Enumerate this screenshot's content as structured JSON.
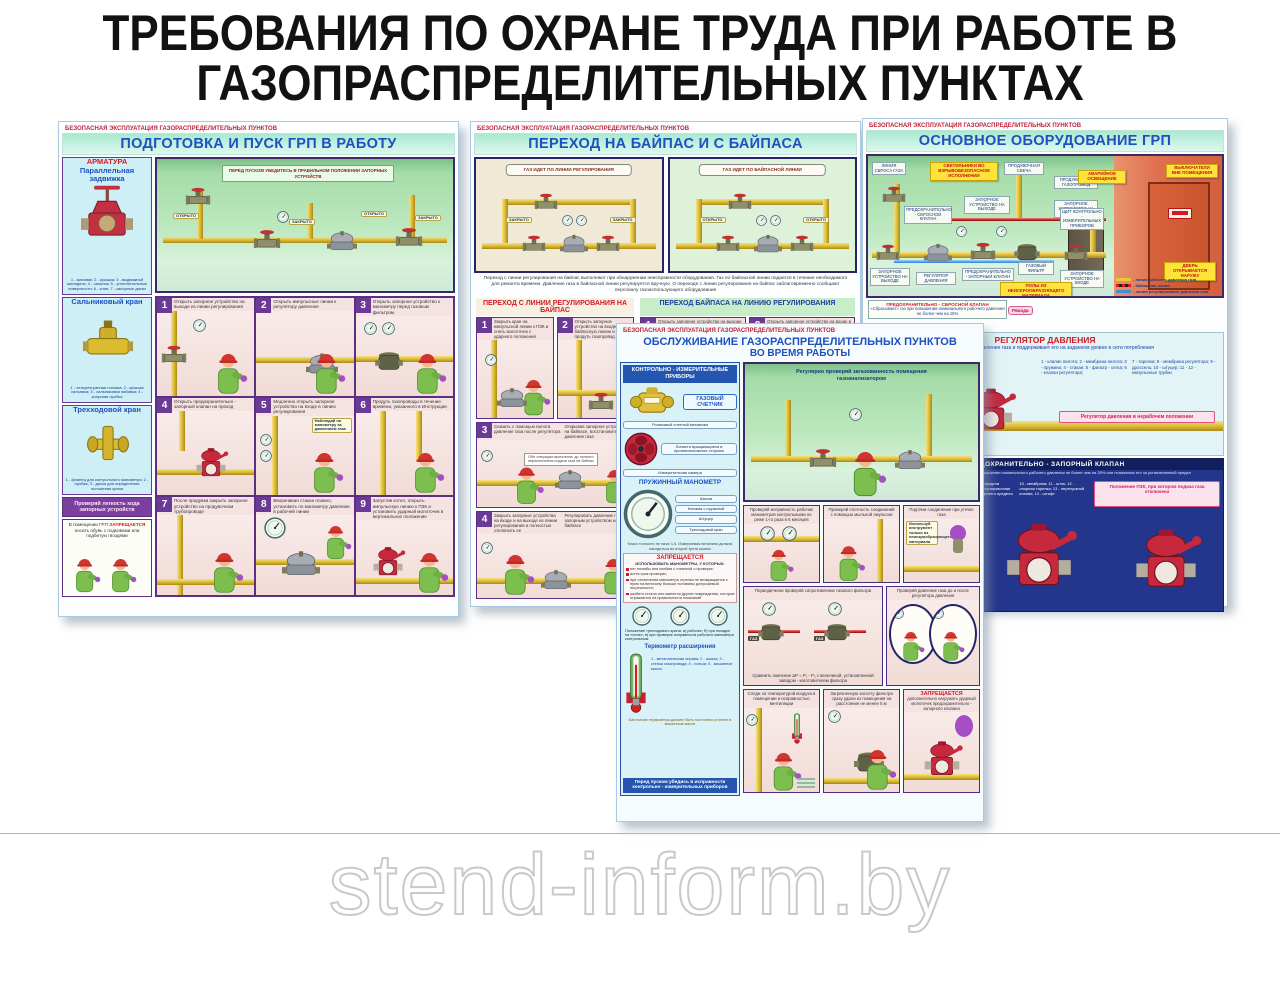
{
  "page": {
    "title_l1": "ТРЕБОВАНИЯ ПО ОХРАНЕ ТРУДА ПРИ РАБОТЕ В",
    "title_l2": "ГАЗОПРАСПРЕДЕЛИТЕЛЬНЫХ ПУНКТАХ",
    "series_label": "БЕЗОПАСНАЯ ЭКСПЛУАТАЦИЯ ГАЗОРАСПРЕДЕЛИТЕЛЬНЫХ ПУНКТОВ",
    "watermark": "stend-inform.by"
  },
  "p1": {
    "title": "ПОДГОТОВКА И ПУСК ГРП В РАБОТУ",
    "arm_title": "АРМАТУРА",
    "arm_sub": "Параллельная задвижка",
    "arm_caption": "1 - маховик; 2 - крышка; 3 - выдвижной шпиндель; 4 - сальник; 5 - уплотнительные поверхности; 6 - клин; 7 - запорные диски",
    "gland_title": "Сальниковый кран",
    "gland_caption": "1 - четырехгранная головка; 2 - крышка сальника; 3 - сальниковая набивка; 4 - конусная пробка",
    "three_title": "Трехходовой кран",
    "three_caption": "1 - фланец для контрольного манометра; 2 - пробка; 3 - диски для определения положения крана",
    "note": "Проверяй легкость хода запорных устройств",
    "warn_a": "В помещении ГРП",
    "warn_b": "ЗАПРЕЩАЕТСЯ",
    "warn_c": "носить обувь с подковами или подбитую гвоздями",
    "banner": "ПЕРЕД ПУСКОМ УБЕДИТЕСЬ В ПРАВИЛЬНОМ ПОЛОЖЕНИИ ЗАПОРНЫХ УСТРОЙСТВ",
    "lbl_open": "ОТКРЫТО",
    "lbl_closed": "ЗАКРЫТО",
    "step5_note": "Наблюдай по манометру за давлением газа",
    "steps": [
      {
        "n": "1",
        "text": "Открыть запорное устройство на выходе из линии регулирования"
      },
      {
        "n": "2",
        "text": "Открыть импульсные линии к регулятору давления"
      },
      {
        "n": "3",
        "text": "Открыть запорное устройство к манометру перед газовым фильтром"
      },
      {
        "n": "4",
        "text": "Открыть предохранительно - запорный клапан на проход"
      },
      {
        "n": "5",
        "text": "Медленно открыть запорное устройство на входе в линию регулирования"
      },
      {
        "n": "6",
        "text": "Продуть газопроводы в течение времени, указанного в Инструкции"
      },
      {
        "n": "7",
        "text": "После продувки закрыть запорное устройство на продувочном трубопроводе"
      },
      {
        "n": "8",
        "text": "Вворачивая стакан плавно, установить по манометру давление в рабочей линии"
      },
      {
        "n": "9",
        "text": "Запустив котел, открыть импульсную линию к ПЗК и установить ударный молоточек в вертикальное положение"
      }
    ]
  },
  "p2": {
    "title": "ПЕРЕХОД НА БАЙПАС И С БАЙПАСА",
    "sch_left": "ГАЗ ИДЕТ ПО ЛИНИИ РЕГУЛИРОВАНИЯ",
    "sch_right": "ГАЗ ИДЕТ ПО БАЙПАСНОЙ ЛИНИИ",
    "lbl_closed": "ЗАКРЫТО",
    "lbl_open": "ОТКРЫТО",
    "paragraph": "Переход с линии регулирования на байпас выполняют при обнаружении неисправности оборудования. Газ по байпасной линии подается в течение необходимого для ремонта времени. Давление газа в байпасной линии регулируется вручную. О переходе с линии регулирования на байпас заблаговременно сообщают персоналу газоиспользующего оборудования",
    "left_title": "ПЕРЕХОД С ЛИНИИ РЕГУЛИРОВАНИЯ НА БАЙПАС",
    "right_title": "ПЕРЕХОД БАЙПАСА НА ЛИНИЮ РЕГУЛИРОВАНИЯ",
    "steps_left": [
      {
        "n": "1",
        "text": "Закрыть кран на импульсной линии к ПЗК и снять молоточек с ударного положения"
      },
      {
        "n": "2",
        "text": "Открыть запорное устройство на входе в байпасную линию и продуть газопровод"
      },
      {
        "n": "3",
        "text": "Снизить с помощью пилота давление газа после регулятора",
        "side": "Открывая запорное устройство на байпасе, восстановить давление газа",
        "extra": "Обе операции выполнять до полного переключения подачи газа на байпас"
      },
      {
        "n": "4",
        "text": "Закрыть запорные устройства на входе и на выходе из линии регулирования и полностью отключить ее",
        "side": "Регулировать давление газа запорным устройством на байпасе"
      }
    ],
    "steps_right": [
      {
        "n": "1",
        "text": "Открыть запорное устройство на выходе из линии регулирования, открыть на проход предохранительно - запорный клапан"
      },
      {
        "n": "2",
        "text": "Открыть запорное устройство на входе в линию регулирования и продуть газопровод"
      }
    ]
  },
  "p3": {
    "title": "ОСНОВНОЕ ОБОРУДОВАНИЕ ГРП",
    "labels": {
      "sbros": "ЛИНИЯ СБРОСА ГАЗА",
      "svet": "СВЕТИЛЬНИКИ ВО ВЗРЫВОБЕЗОПАСНОМ ИСПОЛНЕНИИ",
      "svecha": "ПРОДУВОЧНАЯ СВЕЧА",
      "prod_gas": "ПРОДУВОЧНЫЙ ГАЗОПРОВОД",
      "avar": "АВАРИЙНОЕ ОСВЕЩЕНИЕ",
      "vykl": "ВЫКЛЮЧАТЕЛИ ВНЕ ПОМЕЩЕНИЯ",
      "psk": "ПРЕДОХРАНИТЕЛЬНО - СБРОСНОЙ КЛАПАН",
      "zu_out_top": "ЗАПОРНОЕ УСТРОЙСТВО НА ВЫХОДЕ",
      "zu_in_top": "ЗАПОРНОЕ УСТРОЙСТВО НА ВХОДЕ",
      "shchit": "ЩИТ КОНТРОЛЬНО - ИЗМЕРИТЕЛЬНЫХ ПРИБОРОВ",
      "zu_out_bot": "ЗАПОРНОЕ УСТРОЙСТВО НА ВЫХОДЕ",
      "reg": "РЕГУЛЯТОР ДАВЛЕНИЯ",
      "pzk": "ПРЕДОХРАНИТЕЛЬНО - ЗАПОРНЫЙ КЛАПАН",
      "filter": "ГАЗОВЫЙ ФИЛЬТР",
      "zu_in_bot": "ЗАПОРНОЕ УСТРОЙСТВО НА ВХОДЕ",
      "door": "ДВЕРЬ ОТКРЫВАЕТСЯ НАРУЖУ",
      "pol": "ПОЛЫ ИЗ НЕИСКРООБРАЗУЮЩЕГО МАТЕРИАЛА"
    },
    "legend": [
      "- линия рабочего давления газа",
      "- байпасная линия",
      "- линия регулирования давления газа"
    ],
    "psk_note_title": "ПРЕДОХРАНИТЕЛЬНО - СБРОСНОЙ КЛАПАН",
    "psk_note_text": "«Сбрасывает» газ при повышении номинального рабочего давления не более чем на 15%",
    "p_in": "Рвхода",
    "reg": {
      "title": "РЕГУЛЯТОР ДАВЛЕНИЯ",
      "subtitle": "Снижает входное давление газа и поддерживает его на заданном уровне в сети потребления",
      "parts_a": "1 - клапан пилота; 2 - мембрана пилота; 3 - пружина; 4 - стакан; 5 - фильтр - сетка; 6 - клапан регулятора;",
      "parts_b": "7 - тарелки; 8 - мембрана регулятора; 9 - дроссель; 10 - штуцер; 11 - 12 - импульсные трубки",
      "note": "Регулятор давления в нерабочем положении"
    },
    "pzk": {
      "title": "ПРЕДОХРАНИТЕЛЬНО - ЗАПОРНЫЙ КЛАПАН",
      "subtitle": "Автоматически отключает подачу газа при повышении номинального рабочего давления не более чем на 25% или понижении его за установленный предел",
      "parts_a": "1 - ударный молоточек; 2 - штуцер для подачи импульса давления газа; 3 - анкерный рычаг; 4 - рычаг с грузом; 5 - клапан; 6 - втулка с винтом регулирования;",
      "parts_b": "7 - пружина нижнего предела регулирования; 8 - регулировочная гайка; 9 - пружина верхнего предела регулирования;",
      "parts_c": "10 - мембрана; 11 - шток; 12 - опорная тарелка; 13 - перепускной клапан; 14 - штифт",
      "note": "Положение ПЗК, при котором подача газа отключена"
    }
  },
  "p4": {
    "title_l1": "ОБСЛУЖИВАНИЕ ГАЗОРАСПРЕДЕЛИТЕЛЬНЫХ ПУНКТОВ",
    "title_l2": "ВО ВРЕМЯ РАБОТЫ",
    "kip": {
      "header": "КОНТРОЛЬНО - ИЗМЕРИТЕЛЬНЫЕ ПРИБОРЫ",
      "counter": "ГАЗОВЫЙ СЧЕТЧИК",
      "cap1": "Роликовый счетный механизм",
      "cap2": "Лопасти вращающиеся в противоположные стороны",
      "cap3": "Измерительная камера",
      "manometer": "ПРУЖИННЫЙ МАНОМЕТР",
      "man_note": "Класс точности не ниже 1,5. Измеряемая величина должна находиться во второй трети шкалы",
      "man_lbl1": "Шкала",
      "man_lbl2": "Клемма с пружиной",
      "man_lbl3": "Штуцер",
      "man_lbl4": "Трехходовой кран",
      "forb_title": "ЗАПРЕЩАЕТСЯ",
      "forb_sub": "ИСПОЛЬЗОВАТЬ МАНОМЕТРЫ, У КОТОРЫХ:",
      "forb_items": [
        "нет пломбы или клейма с отметкой о проверке;",
        "истек срок проверки;",
        "при отключении манометра стрелка не возвращается к нулю на величину больше половины допускаемой погрешности;",
        "разбито стекло или имеются другие повреждения, которые отражаются на правильности показаний"
      ],
      "positions": "Положение трехходового крана: а) рабочее; б) при посадке на «ноль»; в) при проверке исправности рабочего манометра контрольным",
      "thermo": "Термометр расширения",
      "thermo_parts": "1 - металлическая оправа; 2 - шкала; 3 - стенка газопровода; 4 - гильза; 5 - машинное масло",
      "thermo_note": "Баллончик термометра должен быть постоянно утоплен в машинном масле",
      "footer": "Перед пуском убедись в исправности контрольно - измерительных приборов"
    },
    "scene_note": "Регулярно проверяй загазованность помещения газоанализатором",
    "panels": {
      "a1": "Проверяй исправность рабочих манометров контрольными не реже 1-го раза в 6 месяцев",
      "a2": "Проверяй плотность соединений с помощью мыльной эмульсии",
      "a3": "Подтяни соединение при утечке газа",
      "a3b": "Используй инструмент только из неискрообразующего материала",
      "b1": "Периодически проверяй сопротивление газового фильтра",
      "b1b": "Сравнить значение ΔР = Р₁ - Р₂ с величиной, установленной заводом - изготовителем фильтра",
      "gas": "ГАЗ",
      "b2": "Проверяй давление газа до и после регулятора давления",
      "c1": "Следи за температурой воздуха в помещении и исправностью вентиляции",
      "c2": "Загрязненную кассету фильтра сразу удали из помещения на расстояние не менее 5 м",
      "c3a": "ЗАПРЕЩАЕТСЯ",
      "c3b": "дополнительно нагружать ударный молоточек предохранительно - запорного клапана"
    }
  }
}
